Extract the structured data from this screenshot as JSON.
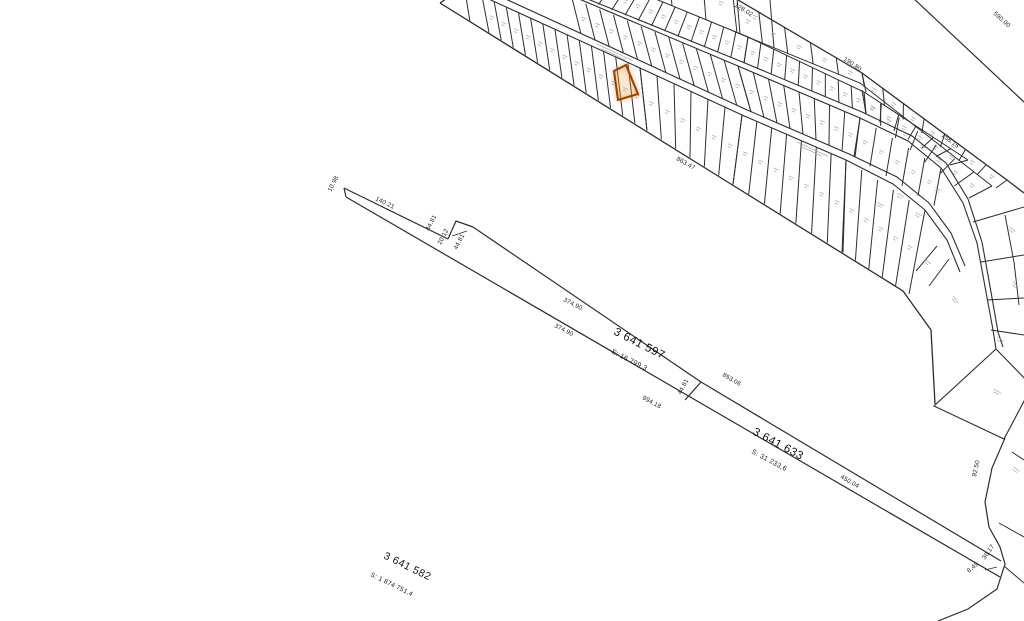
{
  "map_title": "cadastral plan view",
  "colors": {
    "background": "#ffffff",
    "parcel_line": "#2d2d2d",
    "microtext": "#a3a3a3",
    "highlight_stroke": "#8f4108",
    "highlight_glow": "#f09128"
  },
  "parcels": [
    {
      "id": "3 641 597",
      "area": "S: 16 799,3",
      "x": 613,
      "y": 334,
      "rot": 27,
      "area_x": 611,
      "area_y": 353,
      "id_fs": 11.5,
      "area_fs": 7
    },
    {
      "id": "3 641 633",
      "area": "S: 31 233,6",
      "x": 752,
      "y": 434,
      "rot": 28,
      "area_x": 751,
      "area_y": 453,
      "id_fs": 11.5,
      "area_fs": 7
    },
    {
      "id": "3 641 582",
      "area": "S: 1 874 751,4",
      "x": 383,
      "y": 558,
      "rot": 26,
      "area_x": 370,
      "area_y": 576,
      "id_fs": 10.5,
      "area_fs": 6.5
    }
  ],
  "dimensions": [
    {
      "text": "590.00",
      "x": 993,
      "y": 14,
      "rot": 42
    },
    {
      "text": "128.02",
      "x": 734,
      "y": 6,
      "rot": 32
    },
    {
      "text": "190.80",
      "x": 843,
      "y": 60,
      "rot": 34
    },
    {
      "text": "158.15",
      "x": 941,
      "y": 136,
      "rot": 37
    },
    {
      "text": "863.47",
      "x": 676,
      "y": 160,
      "rot": 29
    },
    {
      "text": "10.98",
      "x": 331,
      "y": 192,
      "rot": -63
    },
    {
      "text": "140.21",
      "x": 375,
      "y": 200,
      "rot": 26
    },
    {
      "text": "44.81",
      "x": 429,
      "y": 231,
      "rot": -63
    },
    {
      "text": "20.12",
      "x": 441,
      "y": 245,
      "rot": -63
    },
    {
      "text": "44.81",
      "x": 457,
      "y": 250,
      "rot": -63
    },
    {
      "text": "374.90",
      "x": 563,
      "y": 301,
      "rot": 27
    },
    {
      "text": "374.90",
      "x": 554,
      "y": 327,
      "rot": 27
    },
    {
      "text": "994.18",
      "x": 642,
      "y": 399,
      "rot": 28
    },
    {
      "text": "44.81",
      "x": 681,
      "y": 395,
      "rot": -63
    },
    {
      "text": "853.06",
      "x": 722,
      "y": 376,
      "rot": 30
    },
    {
      "text": "450.04",
      "x": 840,
      "y": 478,
      "rot": 30
    },
    {
      "text": "92.50",
      "x": 976,
      "y": 477,
      "rot": -78
    },
    {
      "text": "36.17",
      "x": 985,
      "y": 560,
      "rot": -55
    },
    {
      "text": "8.49",
      "x": 969,
      "y": 573,
      "rot": -40
    }
  ],
  "geometry": {
    "highlight": {
      "points": "614,71 626,65 638,94 618,100"
    },
    "paths": [
      {
        "d": "M 440,3 L 726,181 L 903,291 L 931,330 L 935,404",
        "w": 1.3
      },
      {
        "d": "M 733,-3 L 862,73 L 1007,180 L 1024,193",
        "w": 1.3
      },
      {
        "d": "M 912,-3 L 1024,102",
        "w": 1.2
      },
      {
        "d": "M 482,-4 L 640,68 L 742,115 L 846,160 L 893,184 L 925,210 L 947,240 L 960,272",
        "w": 1.1
      },
      {
        "d": "M 486,-10 L 643,62 L 745,109 L 849,154 L 897,177 L 929,203 L 951,233 L 965,266",
        "w": 1.1
      },
      {
        "d": "M 572,-4 L 738,66 L 860,118 L 908,141 L 941,168 L 963,203 L 977,243 L 986,292 L 993,330 L 996,349",
        "w": 1.1
      },
      {
        "d": "M 568,-9 L 740,61 L 862,112 L 912,136 L 946,163 L 968,199 L 982,242 L 991,292 L 998,332 L 1003,347",
        "w": 1.1
      },
      {
        "d": "M 590,-28 L 748,37 L 864,92 L 968,160",
        "w": 1
      },
      {
        "d": "M 733,31 L 860,83 L 992,186",
        "w": 1
      },
      {
        "d": "M 996,349 L 934,406 L 1004,439 L 1032,386 Z",
        "w": 1.1
      },
      {
        "d": "M 1005,438 L 992,468 L 985,502 L 989,527 L 1000,547 L 1005,564 L 997,589 L 968,609 L 938,621",
        "w": 1.2
      },
      {
        "d": "M 999,523 L 1024,537",
        "w": 1
      },
      {
        "d": "M 1004,566 L 1024,583",
        "w": 1
      },
      {
        "d": "M 1012,452 L 1024,460",
        "w": 1
      },
      {
        "d": "M 344,188 L 448,239",
        "w": 1.2
      },
      {
        "d": "M 344,188 L 346,197",
        "w": 1.2
      },
      {
        "d": "M 346,197 L 1000,577",
        "w": 1.2
      },
      {
        "d": "M 448,239 L 456,221 L 473,227",
        "w": 1.2
      },
      {
        "d": "M 473,227 L 701,382",
        "w": 1.2
      },
      {
        "d": "M 701,382 L 685,400",
        "w": 1.2
      },
      {
        "d": "M 701,382 L 1001,561",
        "w": 1.2
      },
      {
        "d": "M 452,236 L 467,231",
        "w": 0.8
      },
      {
        "d": "M 985,570 L 997,567",
        "w": 0.8
      },
      {
        "d": "M 440,3 L 452,-5",
        "w": 1.3
      },
      {
        "d": "M 466,-3 L 470,22",
        "w": 1
      },
      {
        "d": "M 973,222 L 1024,207",
        "w": 1
      },
      {
        "d": "M 981,262 L 1024,255",
        "w": 1
      },
      {
        "d": "M 987,300 L 1024,298",
        "w": 1
      },
      {
        "d": "M 991,330 L 1024,335",
        "w": 1
      },
      {
        "d": "M 1005,215 L 1014,262 L 1019,305",
        "w": 1
      },
      {
        "d": "M 937,246 L 916,271",
        "w": 1
      },
      {
        "d": "M 949,259 L 929,286",
        "w": 1
      }
    ],
    "lot_rows": [
      {
        "a": [
          482,
          -4,
          640,
          68
        ],
        "b": [
          482,
          29,
          640,
          127
        ],
        "n": 13,
        "s": 7
      },
      {
        "a": [
          640,
          68,
          742,
          115
        ],
        "b": [
          640,
          127,
          726,
          181
        ],
        "n": 6,
        "s": 7
      },
      {
        "a": [
          742,
          115,
          846,
          160
        ],
        "b": [
          726,
          181,
          836,
          249
        ],
        "n": 7,
        "s": 7
      },
      {
        "a": [
          846,
          160,
          925,
          210
        ],
        "b": [
          836,
          249,
          903,
          291
        ],
        "n": 5,
        "s": 6
      },
      {
        "a": [
          572,
          -2,
          738,
          66
        ],
        "b": [
          575,
          31,
          745,
          109
        ],
        "n": 12,
        "s": 6
      },
      {
        "a": [
          738,
          66,
          860,
          118
        ],
        "b": [
          745,
          109,
          849,
          154
        ],
        "n": 8,
        "s": 6
      },
      {
        "a": [
          860,
          118,
          941,
          168
        ],
        "b": [
          849,
          154,
          929,
          203
        ],
        "n": 5,
        "s": 5
      },
      {
        "a": [
          590,
          -28,
          748,
          37
        ],
        "b": [
          568,
          -8,
          740,
          61
        ],
        "n": 13,
        "s": 4
      },
      {
        "a": [
          748,
          37,
          864,
          92
        ],
        "b": [
          740,
          61,
          862,
          112
        ],
        "n": 9,
        "s": 4
      },
      {
        "a": [
          864,
          92,
          968,
          160
        ],
        "b": [
          862,
          112,
          946,
          163
        ],
        "n": 6,
        "s": 4
      },
      {
        "a": [
          600,
          -70,
          770,
          0
        ],
        "b": [
          600,
          -24,
          770,
          46
        ],
        "n": 5,
        "s": 4
      },
      {
        "a": [
          733,
          -3,
          862,
          73
        ],
        "b": [
          733,
          31,
          860,
          83
        ],
        "n": 5,
        "s": 4
      },
      {
        "a": [
          862,
          73,
          1007,
          180
        ],
        "b": [
          862,
          90,
          992,
          186
        ],
        "n": 7,
        "s": 4
      },
      {
        "a": [
          862,
          90,
          992,
          186
        ],
        "b": [
          862,
          112,
          965,
          196
        ],
        "n": 7,
        "s": 4
      }
    ],
    "marks": [
      {
        "x": 614,
        "y": 53,
        "rot": 25,
        "len": 40
      },
      {
        "x": 812,
        "y": 150,
        "rot": 25,
        "len": 34
      },
      {
        "x": 900,
        "y": 196,
        "rot": 30,
        "len": 8
      },
      {
        "x": 927,
        "y": 262,
        "rot": 40,
        "len": 8
      },
      {
        "x": 955,
        "y": 300,
        "rot": 55,
        "len": 8
      },
      {
        "x": 997,
        "y": 392,
        "rot": 30,
        "len": 9
      },
      {
        "x": 1000,
        "y": 340,
        "rot": 35,
        "len": 8
      },
      {
        "x": 1016,
        "y": 470,
        "rot": 40,
        "len": 7
      },
      {
        "x": 918,
        "y": 215,
        "rot": 30,
        "len": 7
      },
      {
        "x": 938,
        "y": 190,
        "rot": 32,
        "len": 7
      },
      {
        "x": 880,
        "y": 205,
        "rot": 28,
        "len": 7
      },
      {
        "x": 1012,
        "y": 230,
        "rot": 40,
        "len": 7
      },
      {
        "x": 1015,
        "y": 285,
        "rot": 45,
        "len": 7
      }
    ]
  }
}
